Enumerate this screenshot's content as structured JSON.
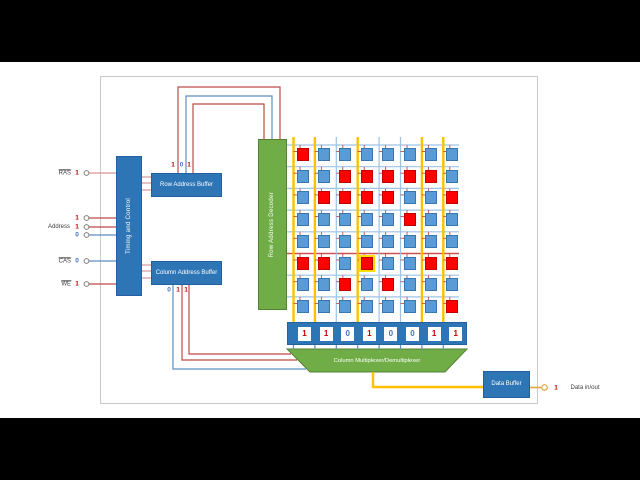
{
  "blocks": {
    "timing_control": "Timing and Control",
    "row_address_buffer": "Row Address Buffer",
    "column_address_buffer": "Column Address Buffer",
    "row_address_decoder": "Row Address Decoder",
    "column_multiplexer": "Column Multiplexer/Demultiplexer",
    "data_buffer": "Data Buffer"
  },
  "inputs": {
    "ras": {
      "label": "RAS",
      "value": "1",
      "value_color": "red"
    },
    "address": {
      "label": "Address",
      "bits": [
        {
          "value": "1",
          "color": "red"
        },
        {
          "value": "1",
          "color": "red"
        },
        {
          "value": "0",
          "color": "blue"
        }
      ]
    },
    "cas": {
      "label": "CAS",
      "value": "0",
      "value_color": "blue"
    },
    "we": {
      "label": "WE",
      "value": "1",
      "value_color": "red"
    }
  },
  "row_address_bits": [
    {
      "value": "1",
      "color": "red"
    },
    {
      "value": "0",
      "color": "blue"
    },
    {
      "value": "1",
      "color": "red"
    }
  ],
  "column_address_bits": [
    {
      "value": "0",
      "color": "blue"
    },
    {
      "value": "1",
      "color": "red"
    },
    {
      "value": "1",
      "color": "red"
    }
  ],
  "sense_register_bits": [
    {
      "value": "1",
      "color": "red"
    },
    {
      "value": "1",
      "color": "red"
    },
    {
      "value": "0",
      "color": "blue"
    },
    {
      "value": "1",
      "color": "red"
    },
    {
      "value": "0",
      "color": "blue"
    },
    {
      "value": "0",
      "color": "blue"
    },
    {
      "value": "1",
      "color": "red"
    },
    {
      "value": "1",
      "color": "red"
    }
  ],
  "output": {
    "value": "1",
    "value_color": "red",
    "label": "Data in/out"
  },
  "memory": {
    "rows": 8,
    "cols": 8,
    "cell_pattern": [
      "10000000",
      "00111110",
      "01111001",
      "00000100",
      "00000000",
      "11010011",
      "00101000",
      "00000001"
    ],
    "active_row": 6,
    "selected_cell": {
      "row": 6,
      "col": 4
    },
    "active_columns": "11010011"
  },
  "colors": {
    "block_blue": "#2E75B6",
    "block_blue_border": "#2260A0",
    "block_green": "#70AD47",
    "block_green_border": "#548235",
    "cell_blue": "#5B9BD5",
    "cell_blue_border": "#3A76AE",
    "cell_red": "#FF0000",
    "cell_red_border": "#C00000",
    "select_yellow": "#FFE000",
    "wire_red": "#BE4B48",
    "wire_pink": "#D99594",
    "wire_blue": "#5E8FC0",
    "word_line": "#9DC3E6",
    "active_word_line": "#D05050",
    "bit_line_active": "#FFC000",
    "bit_line_inactive": "#9DC3E6",
    "data_line_orange": "#E8A33D",
    "circle_gray": "#7F7F7F",
    "text_red": "#C00000",
    "text_blue": "#4472C4",
    "label_dark": "#3F3F3F"
  }
}
